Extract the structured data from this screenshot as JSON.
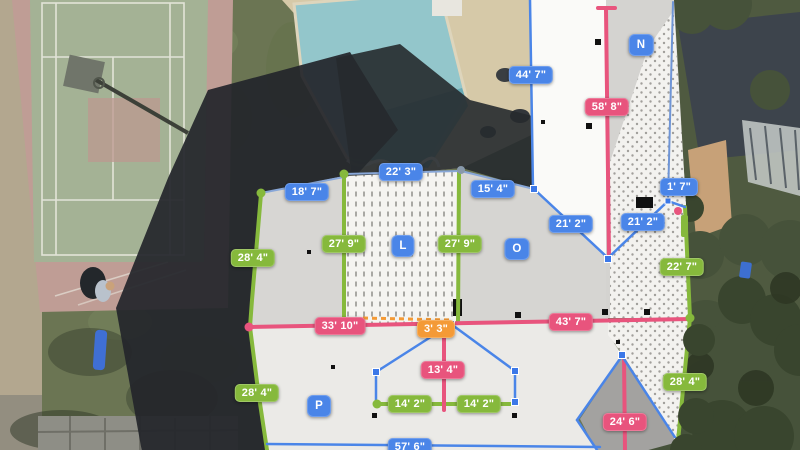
{
  "app": {
    "view_title": "Aerial roof measurement view"
  },
  "palette": {
    "blue": "#4a85e8",
    "green": "#86b93c",
    "pink": "#e8547d",
    "orange": "#f49a36",
    "white_text": "#ffffff"
  },
  "overlay": {
    "facet_labels": [
      {
        "text": "N",
        "color": "blue",
        "x": 641,
        "y": 45
      },
      {
        "text": "L",
        "color": "blue",
        "x": 403,
        "y": 246
      },
      {
        "text": "O",
        "color": "blue",
        "x": 517,
        "y": 249
      },
      {
        "text": "P",
        "color": "blue",
        "x": 319,
        "y": 406
      }
    ],
    "measurements": [
      {
        "text": "44' 7\"",
        "color": "blue",
        "x": 531,
        "y": 75
      },
      {
        "text": "58' 8\"",
        "color": "pink",
        "x": 607,
        "y": 107
      },
      {
        "text": "22' 3\"",
        "color": "blue",
        "x": 401,
        "y": 172
      },
      {
        "text": "18' 7\"",
        "color": "blue",
        "x": 307,
        "y": 192
      },
      {
        "text": "15' 4\"",
        "color": "blue",
        "x": 493,
        "y": 189
      },
      {
        "text": "1' 7\"",
        "color": "blue",
        "x": 679,
        "y": 187
      },
      {
        "text": "21' 2\"",
        "color": "blue",
        "x": 571,
        "y": 224
      },
      {
        "text": "21' 2\"",
        "color": "blue",
        "x": 643,
        "y": 222
      },
      {
        "text": "27' 9\"",
        "color": "green",
        "x": 344,
        "y": 244
      },
      {
        "text": "27' 9\"",
        "color": "green",
        "x": 460,
        "y": 244
      },
      {
        "text": "28' 4\"",
        "color": "green",
        "x": 253,
        "y": 258
      },
      {
        "text": "22' 7\"",
        "color": "green",
        "x": 682,
        "y": 267
      },
      {
        "text": "33' 10\"",
        "color": "pink",
        "x": 340,
        "y": 326
      },
      {
        "text": "43' 7\"",
        "color": "pink",
        "x": 571,
        "y": 322
      },
      {
        "text": "3' 3\"",
        "color": "orange",
        "x": 436,
        "y": 329
      },
      {
        "text": "13' 4\"",
        "color": "pink",
        "x": 443,
        "y": 370
      },
      {
        "text": "14' 2\"",
        "color": "green",
        "x": 410,
        "y": 404
      },
      {
        "text": "14' 2\"",
        "color": "green",
        "x": 479,
        "y": 404
      },
      {
        "text": "28' 4\"",
        "color": "green",
        "x": 257,
        "y": 393
      },
      {
        "text": "28' 4\"",
        "color": "green",
        "x": 685,
        "y": 382
      },
      {
        "text": "24' 6\"",
        "color": "pink",
        "x": 625,
        "y": 422
      },
      {
        "text": "57' 6\"",
        "color": "blue",
        "x": 410,
        "y": 447
      }
    ]
  }
}
